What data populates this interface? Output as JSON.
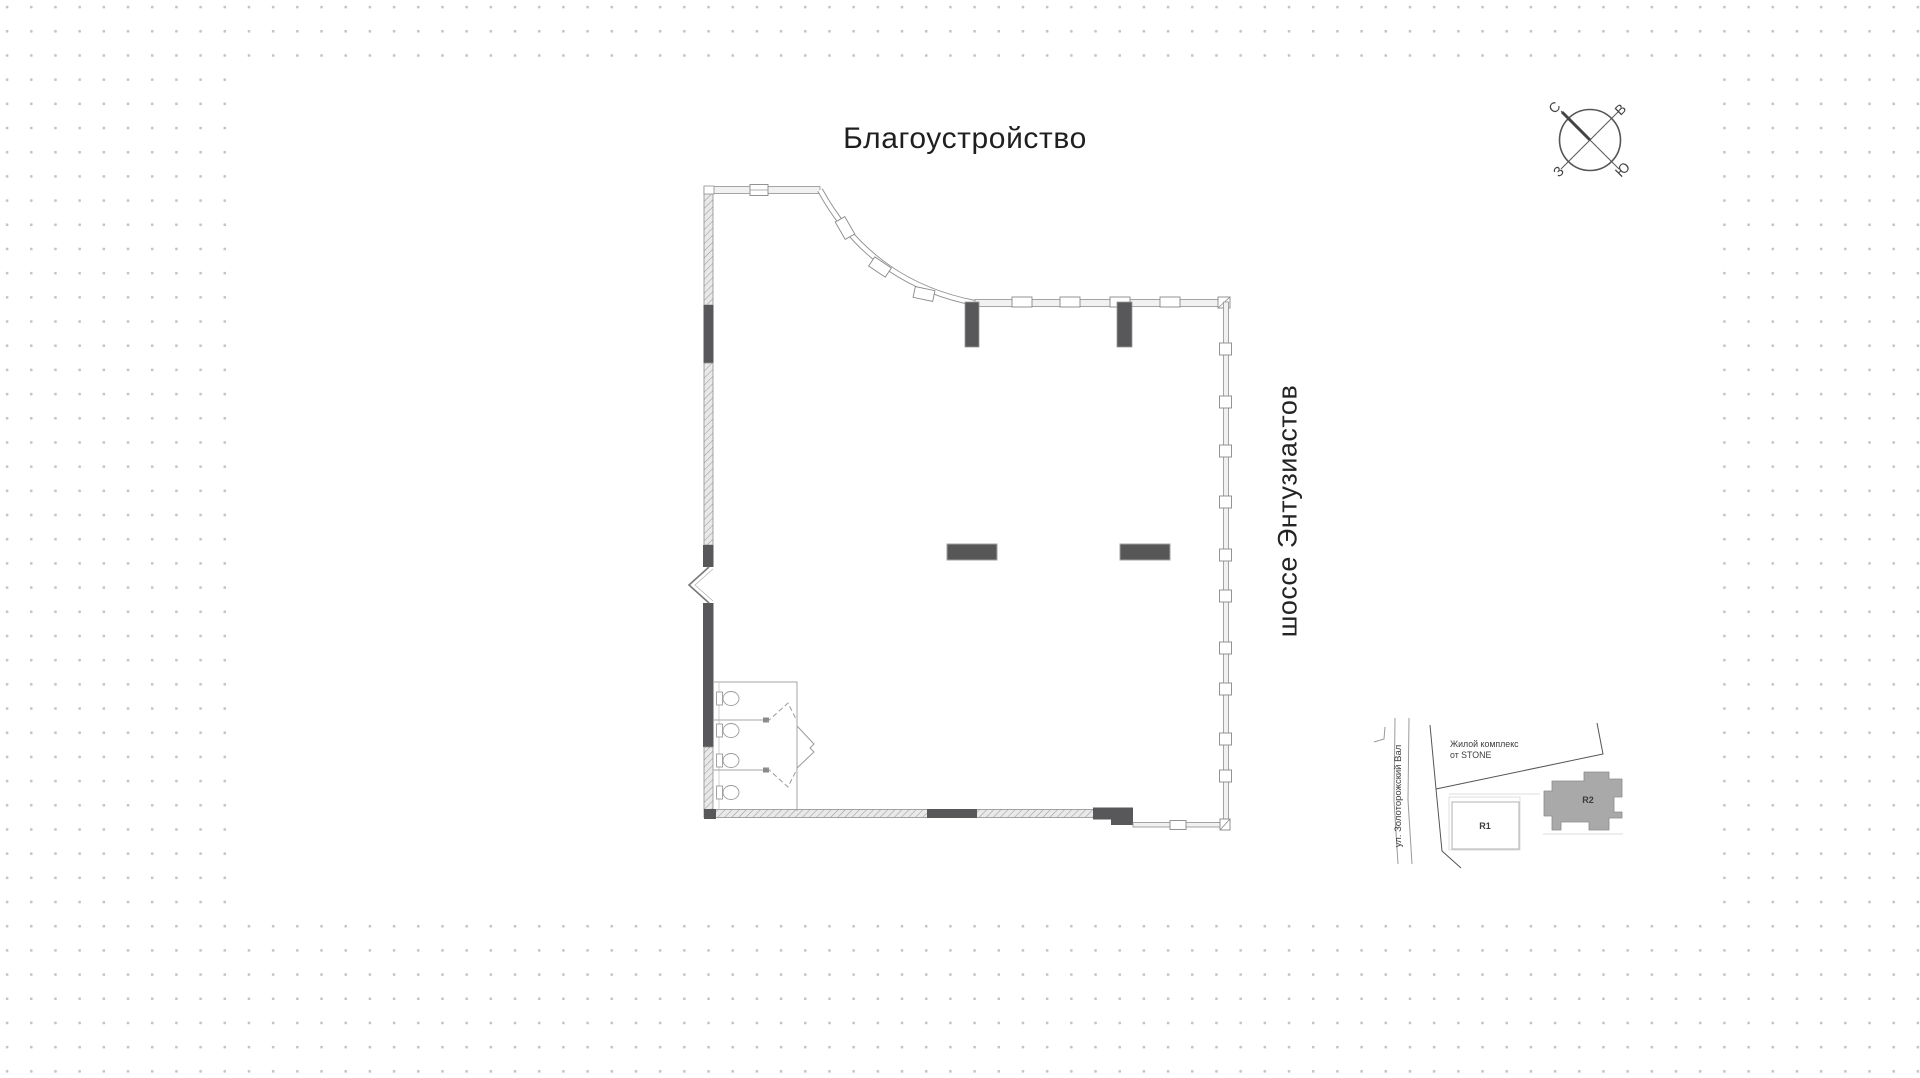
{
  "title": "Благоустройство",
  "highway_label": "шоссе Энтузиастов",
  "compass": {
    "north": "С",
    "east": "В",
    "south": "Ю",
    "west": "З"
  },
  "minimap": {
    "street": "ул. Золоторожский Вал",
    "complex_line1": "Жилой комплекс",
    "complex_line2": "от STONE",
    "building_r1": "R1",
    "building_r2": "R2"
  },
  "colors": {
    "wall_dark": "#58585a",
    "wall_light": "#f1f1f1",
    "line_gray": "#8f8f8f",
    "dot_gray": "#c4c4c4",
    "building_fill": "#a9a9a9"
  }
}
